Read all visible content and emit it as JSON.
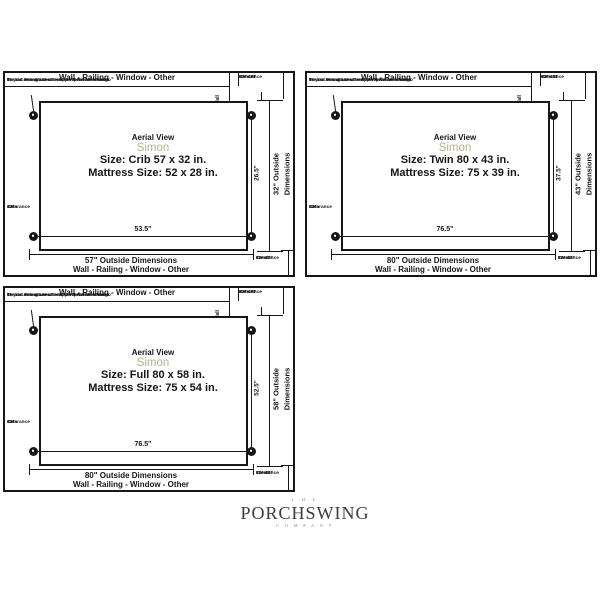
{
  "colors": {
    "line": "#161616",
    "simon_accent": "#b5b183",
    "logo": "#3b3b43"
  },
  "shared": {
    "wall_label": "Wall - Railing - Window - Other",
    "note_line1": "The circles indicate where the rope/chain attach to",
    "note_line2": "the bed. You will need to match these dimensions",
    "note_line3": "on your ceiling and into support beam with hooks.",
    "aerial_view": "Aerial View",
    "model_name": "Simon",
    "clearance_behind_l1": "12\"-18\"",
    "clearance_behind_l2": "Clearance",
    "clearance_behind_l3": "Behind",
    "clearance_front_l1": "12\"-18\"",
    "clearance_front_l2": "Clearance",
    "clearance_front_l3": "Front",
    "clearance_side_l1": "12\"",
    "clearance_side_l2": "Clearance",
    "clearance_side_l3": "Side"
  },
  "panels": [
    {
      "bed_type": "crib",
      "size_label": "Size: Crib 57 x 32 in.",
      "mattress_label": "Mattress Size: 52 x 28 in.",
      "hanging_label": "2pt.Hanging - 28\" From Wall",
      "hanging_width_label": "26.5\"",
      "hanging_length_label": "53.5\"",
      "outside_width_label": "57\" Outside Dimensions",
      "outside_depth_line1": "32\" Outside",
      "outside_depth_line2": "Dimensions"
    },
    {
      "bed_type": "twin",
      "size_label": "Size: Twin 80 x 43 in.",
      "mattress_label": "Mattress Size: 75 x 39 in.",
      "hanging_label": "2pt.Hanging - 40\" From Wall",
      "hanging_width_label": "37.5\"",
      "hanging_length_label": "76.5\"",
      "outside_width_label": "80\" Outside Dimensions",
      "outside_depth_line1": "43\" Outside",
      "outside_depth_line2": "Dimensions"
    },
    {
      "bed_type": "full",
      "size_label": "Size: Full 80 x 58 in.",
      "mattress_label": "Mattress Size: 75 x 54 in.",
      "hanging_label": "2pt.Hanging - 47\" From Wall",
      "hanging_width_label": "52.5\"",
      "hanging_length_label": "76.5\"",
      "outside_width_label": "80\" Outside Dimensions",
      "outside_depth_line1": "58\" Outside",
      "outside_depth_line2": "Dimensions"
    }
  ],
  "logo": {
    "the": "T H E",
    "name": "PORCHSWING",
    "company": "C O M P A N Y"
  }
}
